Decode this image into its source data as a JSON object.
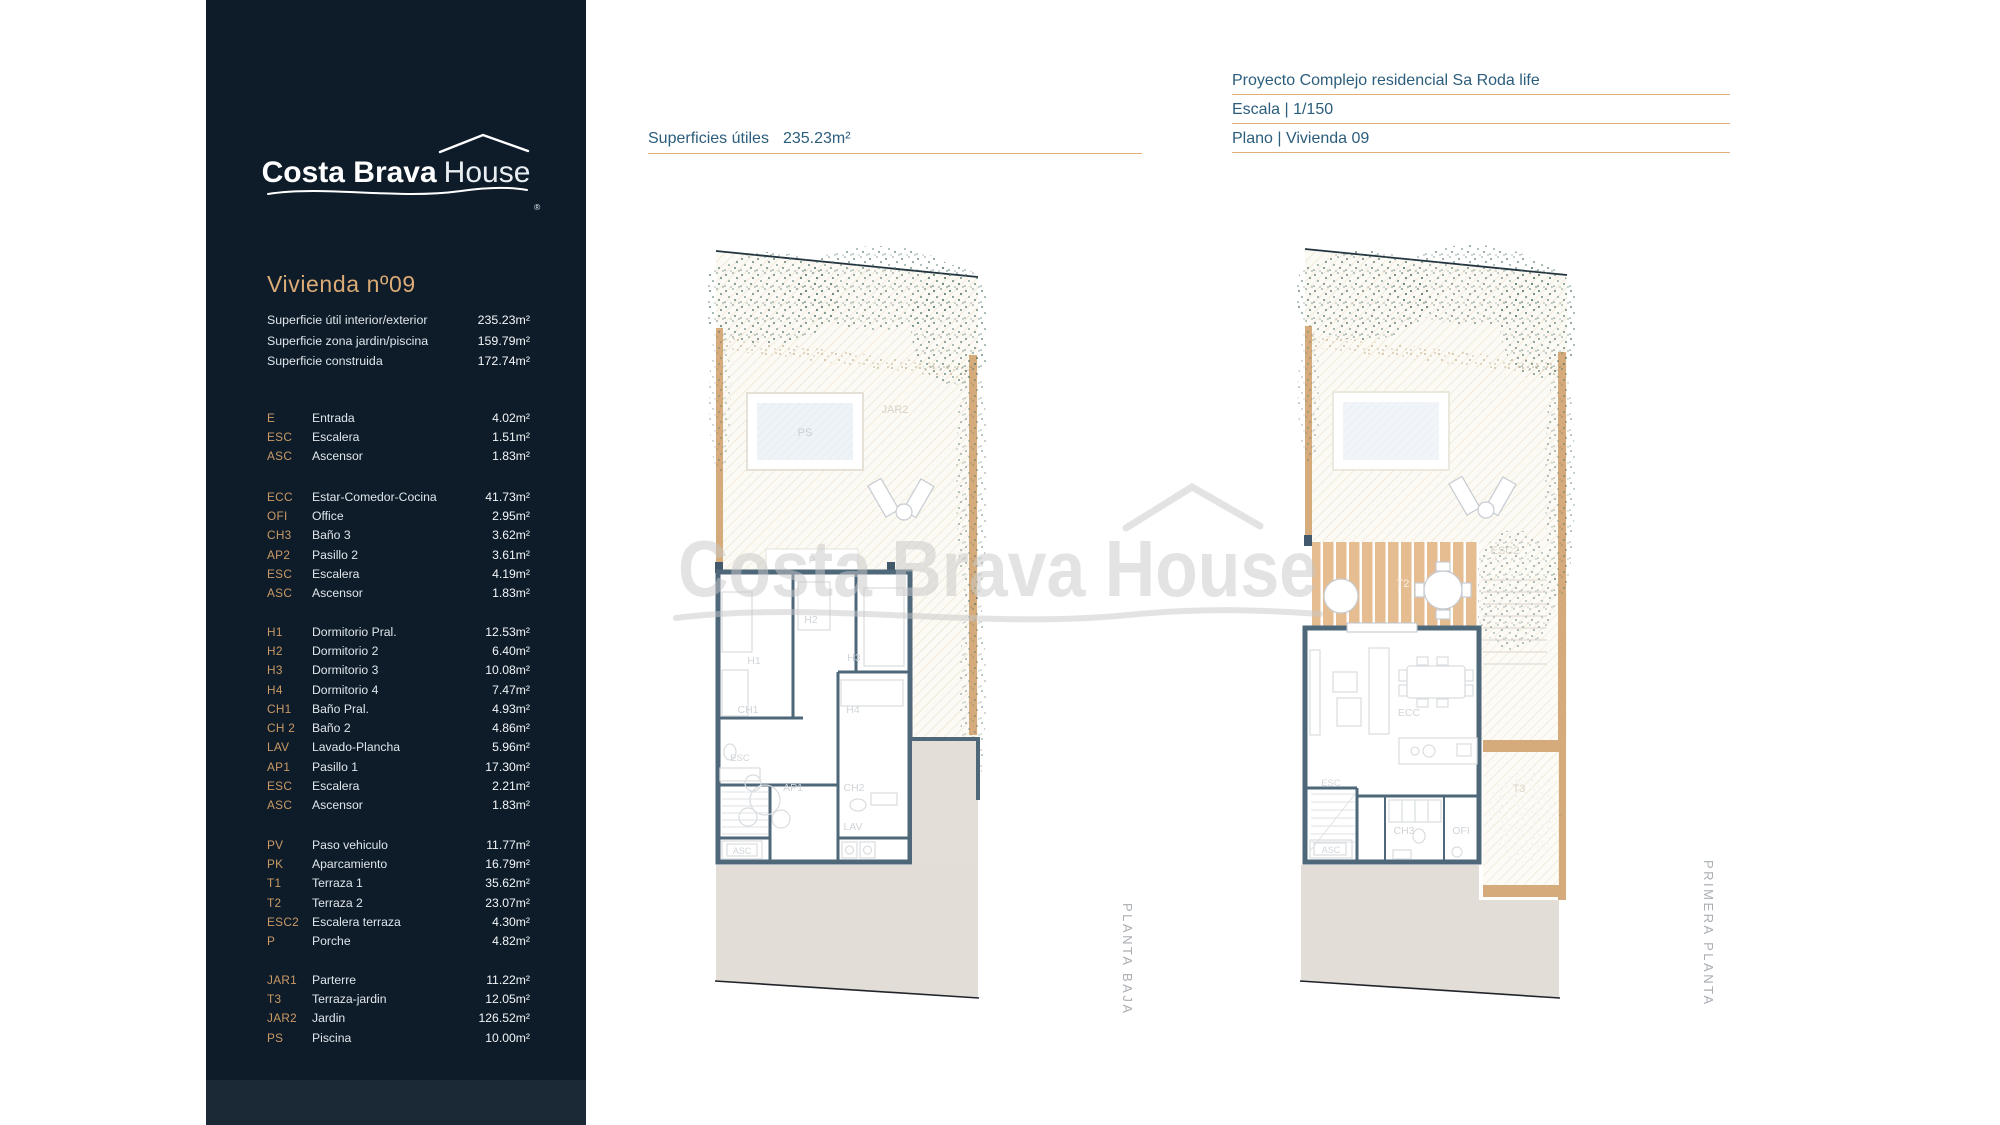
{
  "colors": {
    "sidebar_bg": "#0e1c2a",
    "accent_gold": "#dcab76",
    "underline_gold": "#e3ae7a",
    "heading_teal": "#2c5d7c",
    "wall_slate": "#4e6779",
    "paving_beige": "#e2ded7",
    "wood_tan": "#d6ab7b",
    "vegetation_green": "#4f7467"
  },
  "sidebar": {
    "logo": {
      "brand_bold": "Costa Brava",
      "brand_light": "House",
      "registered": "®"
    },
    "title": "Vivienda nº09",
    "summary": [
      {
        "label": "Superficie útil interior/exterior",
        "value": "235.23m²"
      },
      {
        "label": "Superficie zona jardin/piscina",
        "value": "159.79m²"
      },
      {
        "label": "Superficie construida",
        "value": "172.74m²"
      }
    ],
    "groups": [
      {
        "rows": [
          {
            "code": "E",
            "label": "Entrada",
            "value": "4.02m²"
          },
          {
            "code": "ESC",
            "label": "Escalera",
            "value": "1.51m²"
          },
          {
            "code": "ASC",
            "label": "Ascensor",
            "value": "1.83m²"
          }
        ]
      },
      {
        "rows": [
          {
            "code": "ECC",
            "label": "Estar-Comedor-Cocina",
            "value": "41.73m²"
          },
          {
            "code": "OFI",
            "label": "Office",
            "value": "2.95m²"
          },
          {
            "code": "CH3",
            "label": "Baño 3",
            "value": "3.62m²"
          },
          {
            "code": "AP2",
            "label": "Pasillo 2",
            "value": "3.61m²"
          },
          {
            "code": "ESC",
            "label": "Escalera",
            "value": "4.19m²"
          },
          {
            "code": "ASC",
            "label": "Ascensor",
            "value": "1.83m²"
          }
        ]
      },
      {
        "rows": [
          {
            "code": "H1",
            "label": "Dormitorio Pral.",
            "value": "12.53m²"
          },
          {
            "code": "H2",
            "label": "Dormitorio 2",
            "value": "6.40m²"
          },
          {
            "code": "H3",
            "label": "Dormitorio 3",
            "value": "10.08m²"
          },
          {
            "code": "H4",
            "label": "Dormitorio 4",
            "value": "7.47m²"
          },
          {
            "code": "CH1",
            "label": "Baño Pral.",
            "value": "4.93m²"
          },
          {
            "code": "CH 2",
            "label": "Baño 2",
            "value": "4.86m²"
          },
          {
            "code": "LAV",
            "label": "Lavado-Plancha",
            "value": "5.96m²"
          },
          {
            "code": "AP1",
            "label": "Pasillo 1",
            "value": "17.30m²"
          },
          {
            "code": "ESC",
            "label": "Escalera",
            "value": "2.21m²"
          },
          {
            "code": "ASC",
            "label": "Ascensor",
            "value": "1.83m²"
          }
        ]
      },
      {
        "rows": [
          {
            "code": "PV",
            "label": "Paso vehiculo",
            "value": "11.77m²"
          },
          {
            "code": "PK",
            "label": "Aparcamiento",
            "value": "16.79m²"
          },
          {
            "code": "T1",
            "label": "Terraza 1",
            "value": "35.62m²"
          },
          {
            "code": "T2",
            "label": "Terraza 2",
            "value": "23.07m²"
          },
          {
            "code": "ESC2",
            "label": "Escalera terraza",
            "value": "4.30m²"
          },
          {
            "code": "P",
            "label": "Porche",
            "value": "4.82m²"
          }
        ]
      },
      {
        "rows": [
          {
            "code": "JAR1",
            "label": "Parterre",
            "value": "11.22m²"
          },
          {
            "code": "T3",
            "label": "Terraza-jardin",
            "value": "12.05m²"
          },
          {
            "code": "JAR2",
            "label": "Jardin",
            "value": "126.52m²"
          },
          {
            "code": "PS",
            "label": "Piscina",
            "value": "10.00m²"
          }
        ]
      }
    ]
  },
  "header": {
    "lines": [
      "Proyecto Complejo residencial Sa Roda life",
      "Escala | 1/150",
      "Plano | Vivienda 09"
    ]
  },
  "plan_header": {
    "label": "Superficies útiles",
    "value": "235.23m²"
  },
  "watermark": {
    "text": "Costa Brava House"
  },
  "plans": {
    "left": {
      "caption": "PLANTA BAJA",
      "labels": {
        "p": "P",
        "jar2": "JAR2",
        "ps": "PS",
        "h1": "H1",
        "h2": "H2",
        "h3": "H3",
        "h4": "H4",
        "ch1": "CH1",
        "ch2": "CH2",
        "esc": "ESC",
        "ap1": "AP1",
        "lav": "LAV",
        "asc": "ASC"
      }
    },
    "right": {
      "caption": "PRIMERA PLANTA",
      "labels": {
        "t2": "T2",
        "esc2": "ESC2",
        "ecc": "ECC",
        "esc": "ESC",
        "asc": "ASC",
        "ch3": "CH3",
        "ofi": "OFI",
        "t3": "T3"
      }
    }
  }
}
